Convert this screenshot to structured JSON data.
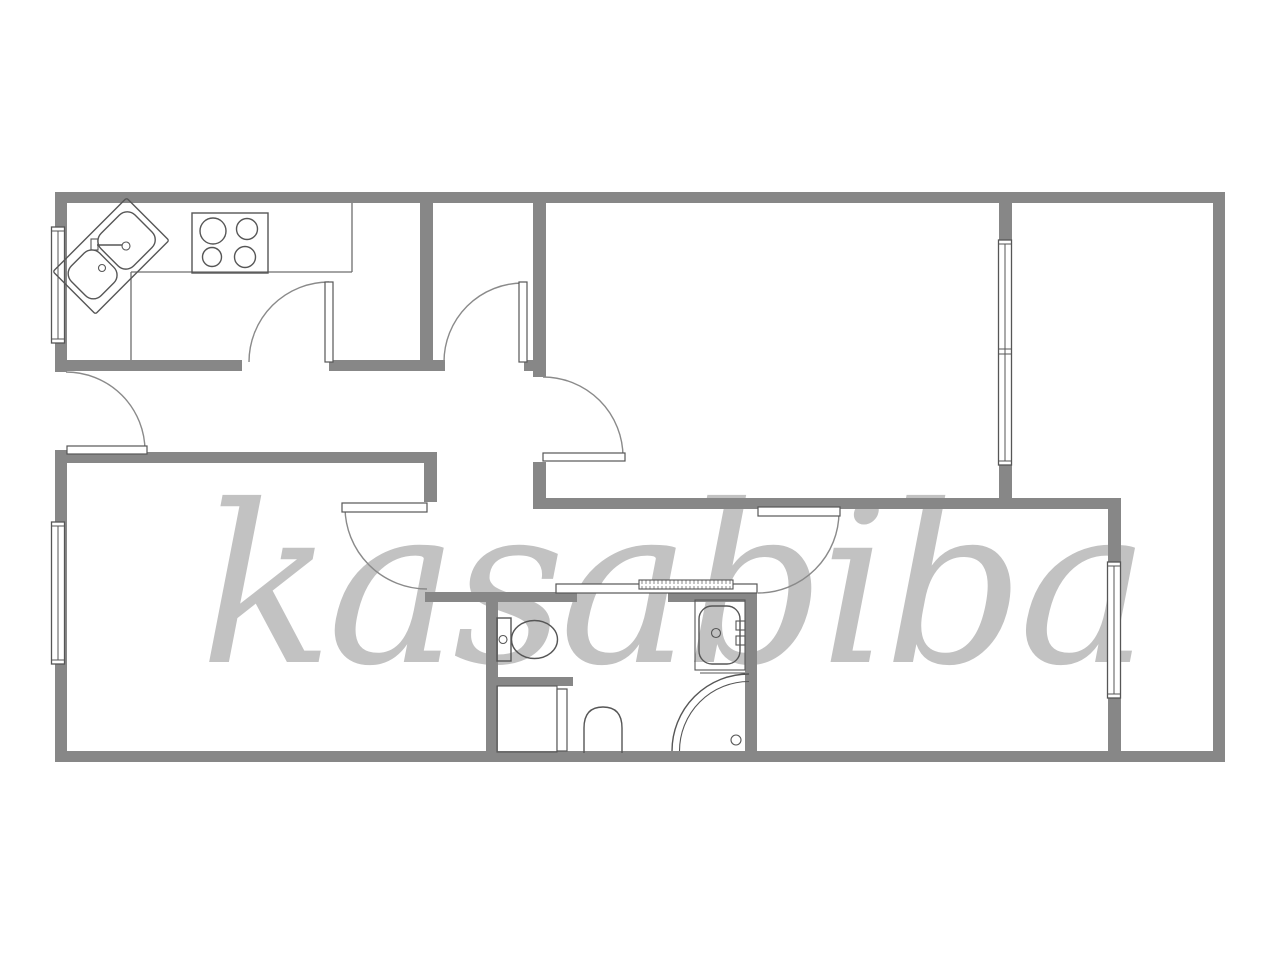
{
  "watermark": {
    "text": "kasabiba"
  },
  "colors": {
    "background": "#ffffff",
    "wall": "#878787",
    "line": "#565656",
    "arc": "#8a8a8a",
    "watermark": "#c2c2c2"
  },
  "fixtures": [
    "corner-kitchen-sink",
    "stove-4-burners",
    "toilet",
    "washbasin",
    "corner-shower",
    "wardrobe-with-door",
    "sliding-door",
    "swing-doors-x6",
    "windows-x4"
  ]
}
